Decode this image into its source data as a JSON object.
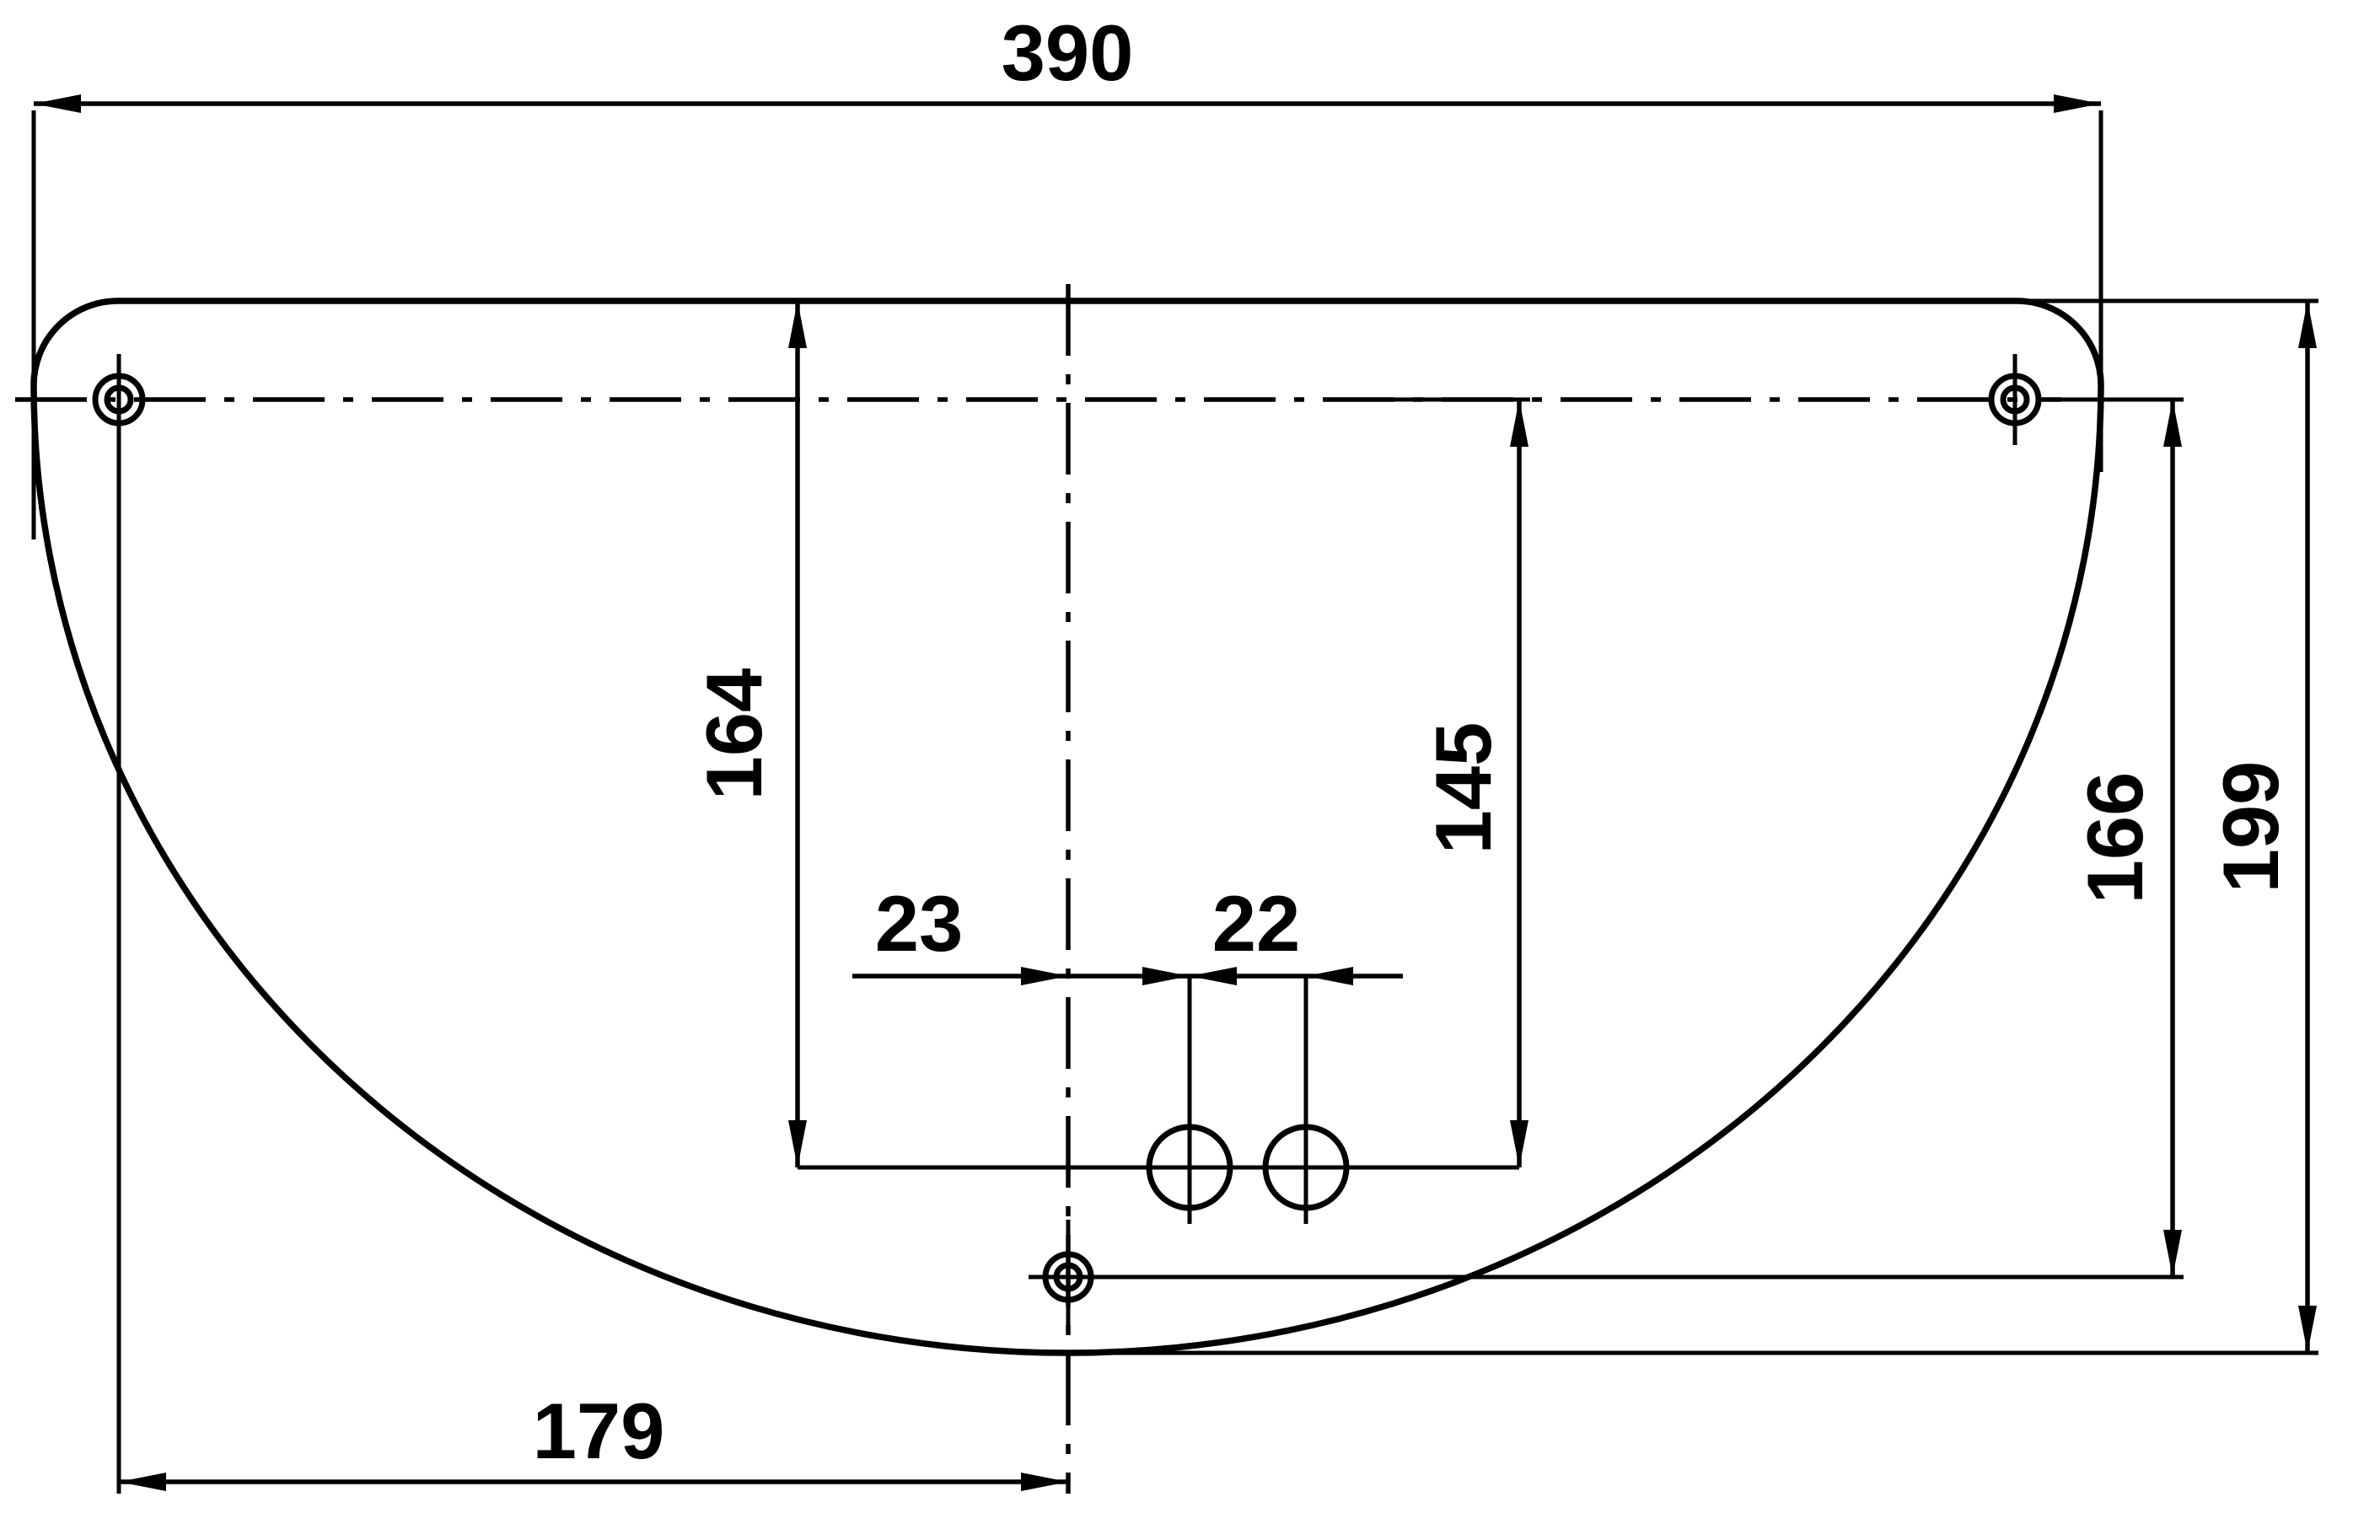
{
  "colors": {
    "ink": "#000000",
    "paper": "#ffffff"
  },
  "drawing": {
    "kind": "engineering-dimension-drawing",
    "part_shape": "plate with straight top edge, rounded top corners, semi-elliptical bottom edge, three target-marked mounting holes and two small circular holes"
  },
  "dims": {
    "d390": "390",
    "d164": "164",
    "d145": "145",
    "d23": "23",
    "d22": "22",
    "d166": "166",
    "d199": "199",
    "d179": "179"
  }
}
